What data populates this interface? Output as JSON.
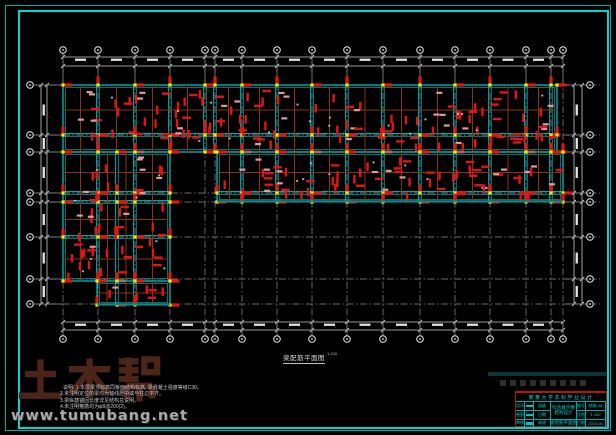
{
  "drawing": {
    "title": "梁配筋平面图",
    "scale": "1:100",
    "notes": [
      "说明: 1.本层梁顶标高同板面结构标高, 梁混凝土强度等级C30。",
      "2.未注明定位的梁均为轴线居中或与柱边平齐。",
      "3.梁纵筋锚固长度详见结构总说明。",
      "4.未注明箍筋均为φ8@200(2)。"
    ]
  },
  "watermark": {
    "text": "土木帮",
    "url": "www.tumubang.net"
  },
  "title_block": {
    "header": "某某大学本科毕业设计",
    "project": "综合教学楼结构设计",
    "sheet_name": "梁配筋平面图",
    "left_rows": [
      {
        "label": "设计"
      },
      {
        "label": "制图"
      },
      {
        "label": "审核"
      }
    ],
    "mid_rows": [
      {
        "label": "班级"
      },
      {
        "label": "日期"
      },
      {
        "label": "成绩"
      }
    ],
    "right_rows": [
      {
        "label": "图号",
        "value": "结施-08"
      },
      {
        "label": "比例",
        "value": "1:100"
      },
      {
        "label": "日期",
        "value": "2015.06"
      }
    ]
  },
  "plan": {
    "x_grid": [
      63,
      98,
      135,
      170,
      205,
      215,
      242,
      277,
      312,
      347,
      383,
      420,
      455,
      490,
      526,
      551,
      563
    ],
    "y_grid": [
      85,
      135,
      152,
      193,
      202,
      237,
      279,
      304
    ],
    "bands": [
      {
        "rect": [
          63,
          85,
          557,
          152
        ]
      },
      {
        "rect": [
          217,
          152,
          563,
          202
        ],
        "heavy_bottom": true
      },
      {
        "rect": [
          63,
          152,
          170,
          281
        ],
        "extra_x": [
          117
        ]
      },
      {
        "rect": [
          97,
          281,
          170,
          305
        ],
        "extra_x": [
          117
        ],
        "heavy_bottom": true
      }
    ],
    "dims": {
      "top": [
        57,
        66
      ],
      "bottom": [
        322,
        330
      ],
      "left": [
        41,
        47
      ],
      "right": [
        574,
        582
      ],
      "h_span": [
        63,
        563
      ],
      "v_span": [
        85,
        304
      ]
    },
    "bubbles": {
      "top_y": 50,
      "bottom_y": 339,
      "left_x": 30,
      "right_x": 590
    },
    "colors": {
      "beam": "#00e0e0",
      "beam_dark": "#00a0a0",
      "secondary": "#8a3310",
      "column": "#e41414",
      "label": "#e09a9a",
      "node": "#ecec00",
      "grid": "#8f8f8f",
      "dim": "#c8c8c8",
      "dim_text": "#e2e2e2",
      "bubble": "#efefef",
      "heavy": "#0c8b8b"
    }
  }
}
